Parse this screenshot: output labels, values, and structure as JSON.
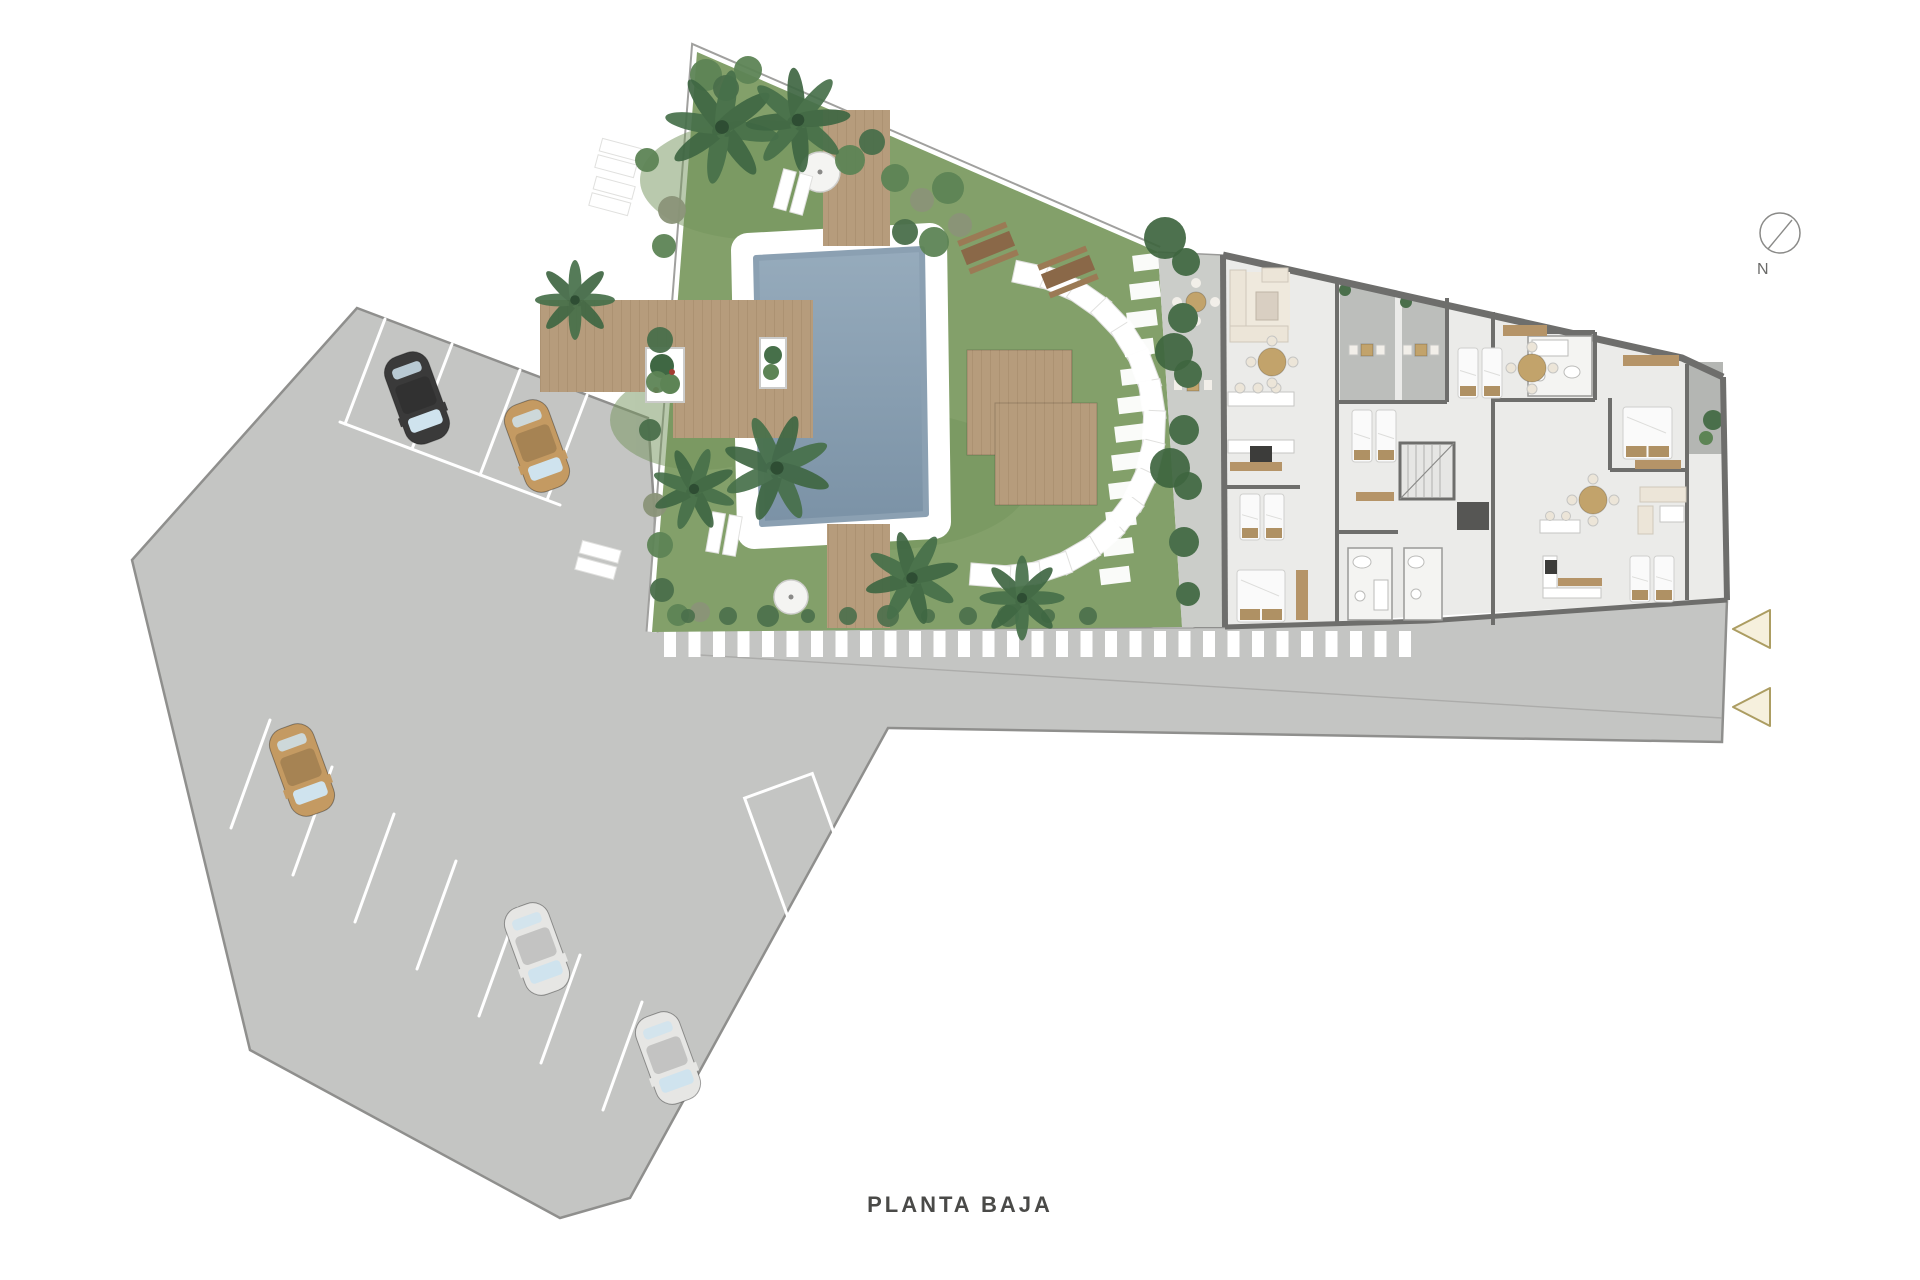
{
  "title": {
    "label": "PLANTA BAJA"
  },
  "compass": {
    "label": "N"
  },
  "entry_arrows": {
    "count": 2,
    "direction": "left"
  },
  "cars": [
    {
      "id": "car-1",
      "color_name": "black"
    },
    {
      "id": "car-2",
      "color_name": "tan"
    },
    {
      "id": "car-3",
      "color_name": "tan"
    },
    {
      "id": "car-4",
      "color_name": "white"
    },
    {
      "id": "car-5",
      "color_name": "white"
    }
  ],
  "palette": {
    "pavement": "#c4c5c3",
    "pavement_border": "#8f8f8d",
    "stall_line": "#ffffff",
    "grass": "#83a06a",
    "grass_dark": "#74935c",
    "deck_wood": "#b69c7c",
    "pool_light": "#96abbc",
    "pool_dark": "#7b92a6",
    "building_floor": "#ebebe9",
    "building_wall": "#6e6e6c",
    "terrace": "#bcbebb",
    "patio": "#cbcdc9",
    "hedge": "#4a6f4b",
    "palm": "#47704a",
    "bush_light": "#5d8455",
    "furniture_cream": "#ece5d8",
    "furniture_tan": "#c2a36b",
    "wood_trim": "#b59468",
    "bed_white": "#fafafa",
    "pillow_tan": "#af9164",
    "arrow_fill": "#f6f0dd",
    "arrow_stroke": "#ac9d62",
    "car_black": "#3a3a3a",
    "car_tan": "#c49a62",
    "car_white": "#e6e6e4",
    "car_glass": "#cfe3ee",
    "text": "#4a4a48"
  }
}
